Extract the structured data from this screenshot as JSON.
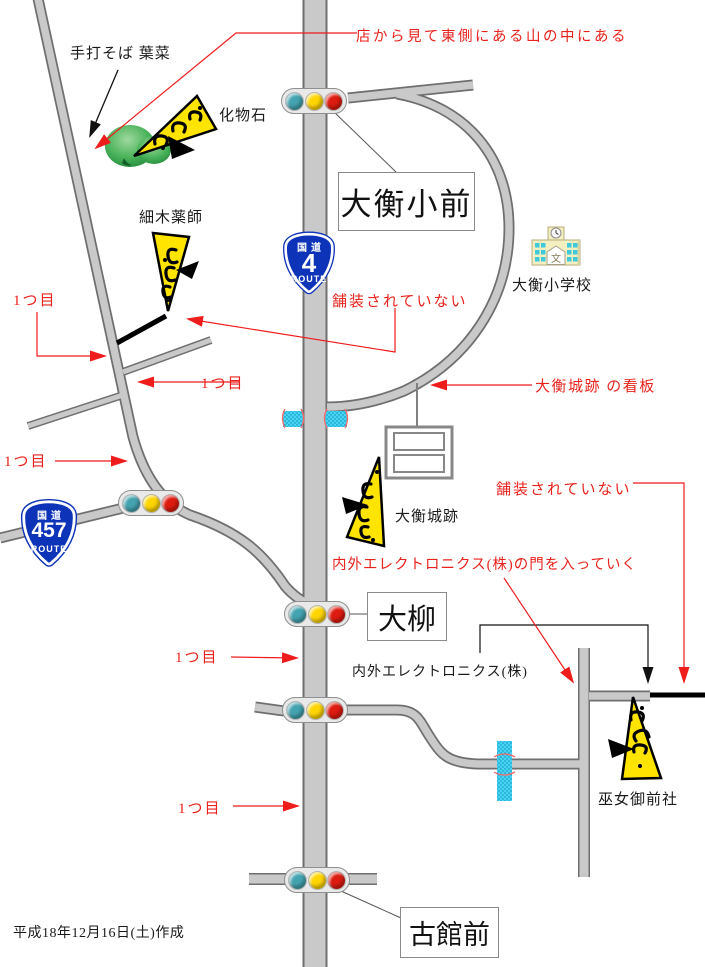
{
  "title": "手書き道順地図",
  "labels": {
    "soba_shop": "手打そば 葉菜",
    "bakemono_ishi": "化物石",
    "hosoki_yakushi": "細木薬師",
    "elementary_school": "大衡小学校",
    "castle_ruins": "大衡城跡",
    "naigai_electronics": "内外エレクトロニクス(株)",
    "miko_gozen_shrine": "巫女御前社",
    "created_date": "平成18年12月16日(土)作成"
  },
  "intersection_boxes": {
    "ohira_sho_mae": "大衡小前",
    "oyanagi": "大柳",
    "furudate_mae": "古館前"
  },
  "notes_red": {
    "mountain_note": "店から見て東側にある山の中にある",
    "unpaved_upper": "舗装されていない",
    "unpaved_right": "舗装されていない",
    "castle_sign_note": "大衡城跡 の看板",
    "gate_note": "内外エレクトロニクス(株)の門を入っていく",
    "first_marks": [
      "1つ目",
      "1つ目",
      "1つ目",
      "1つ目",
      "1つ目"
    ]
  },
  "route_shields": {
    "route4": {
      "top": "国道",
      "number": "4",
      "bottom": "ROUTE"
    },
    "route457": {
      "top": "国道",
      "number": "457",
      "bottom": "ROUTE"
    }
  },
  "map_icons": {
    "school_mark": "文"
  },
  "colors": {
    "road_gray": "#c9c9c9",
    "road_outline": "#6f6f6f",
    "annotation_red": "#e8221c",
    "marker_yellow": "#ffe400",
    "bridge_cyan": "#45d6f4",
    "shield_blue": "#0d33b8",
    "signal_teal": "#44a3b0",
    "signal_yellow": "#ffd500",
    "signal_red": "#dd1b10"
  }
}
